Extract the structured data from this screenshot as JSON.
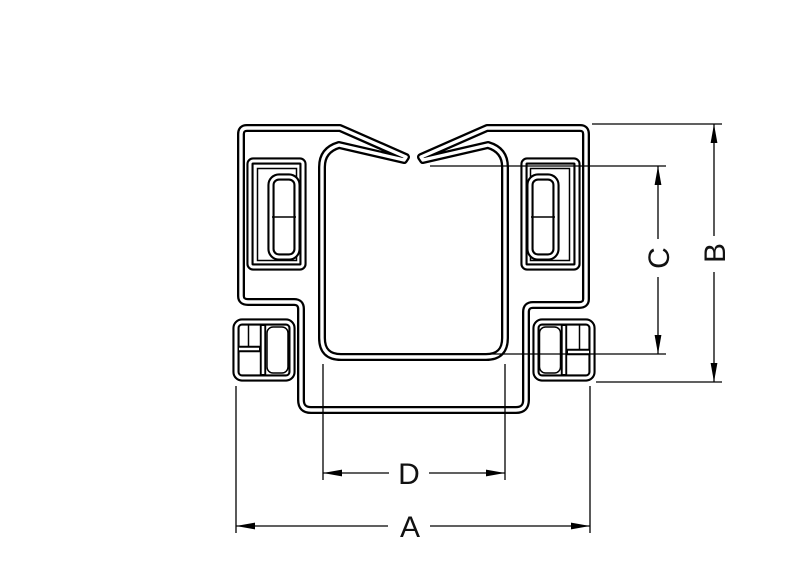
{
  "drawing": {
    "background_color": "#ffffff",
    "line_color": "#000000",
    "dimensions": {
      "a": {
        "label": "A",
        "orientation": "horizontal",
        "position": "bottom-overall-width"
      },
      "b": {
        "label": "B",
        "orientation": "vertical",
        "position": "right-overall-height"
      },
      "c": {
        "label": "C",
        "orientation": "vertical",
        "position": "right-inner-depth"
      },
      "d": {
        "label": "D",
        "orientation": "horizontal",
        "position": "bottom-inner-width"
      }
    }
  }
}
